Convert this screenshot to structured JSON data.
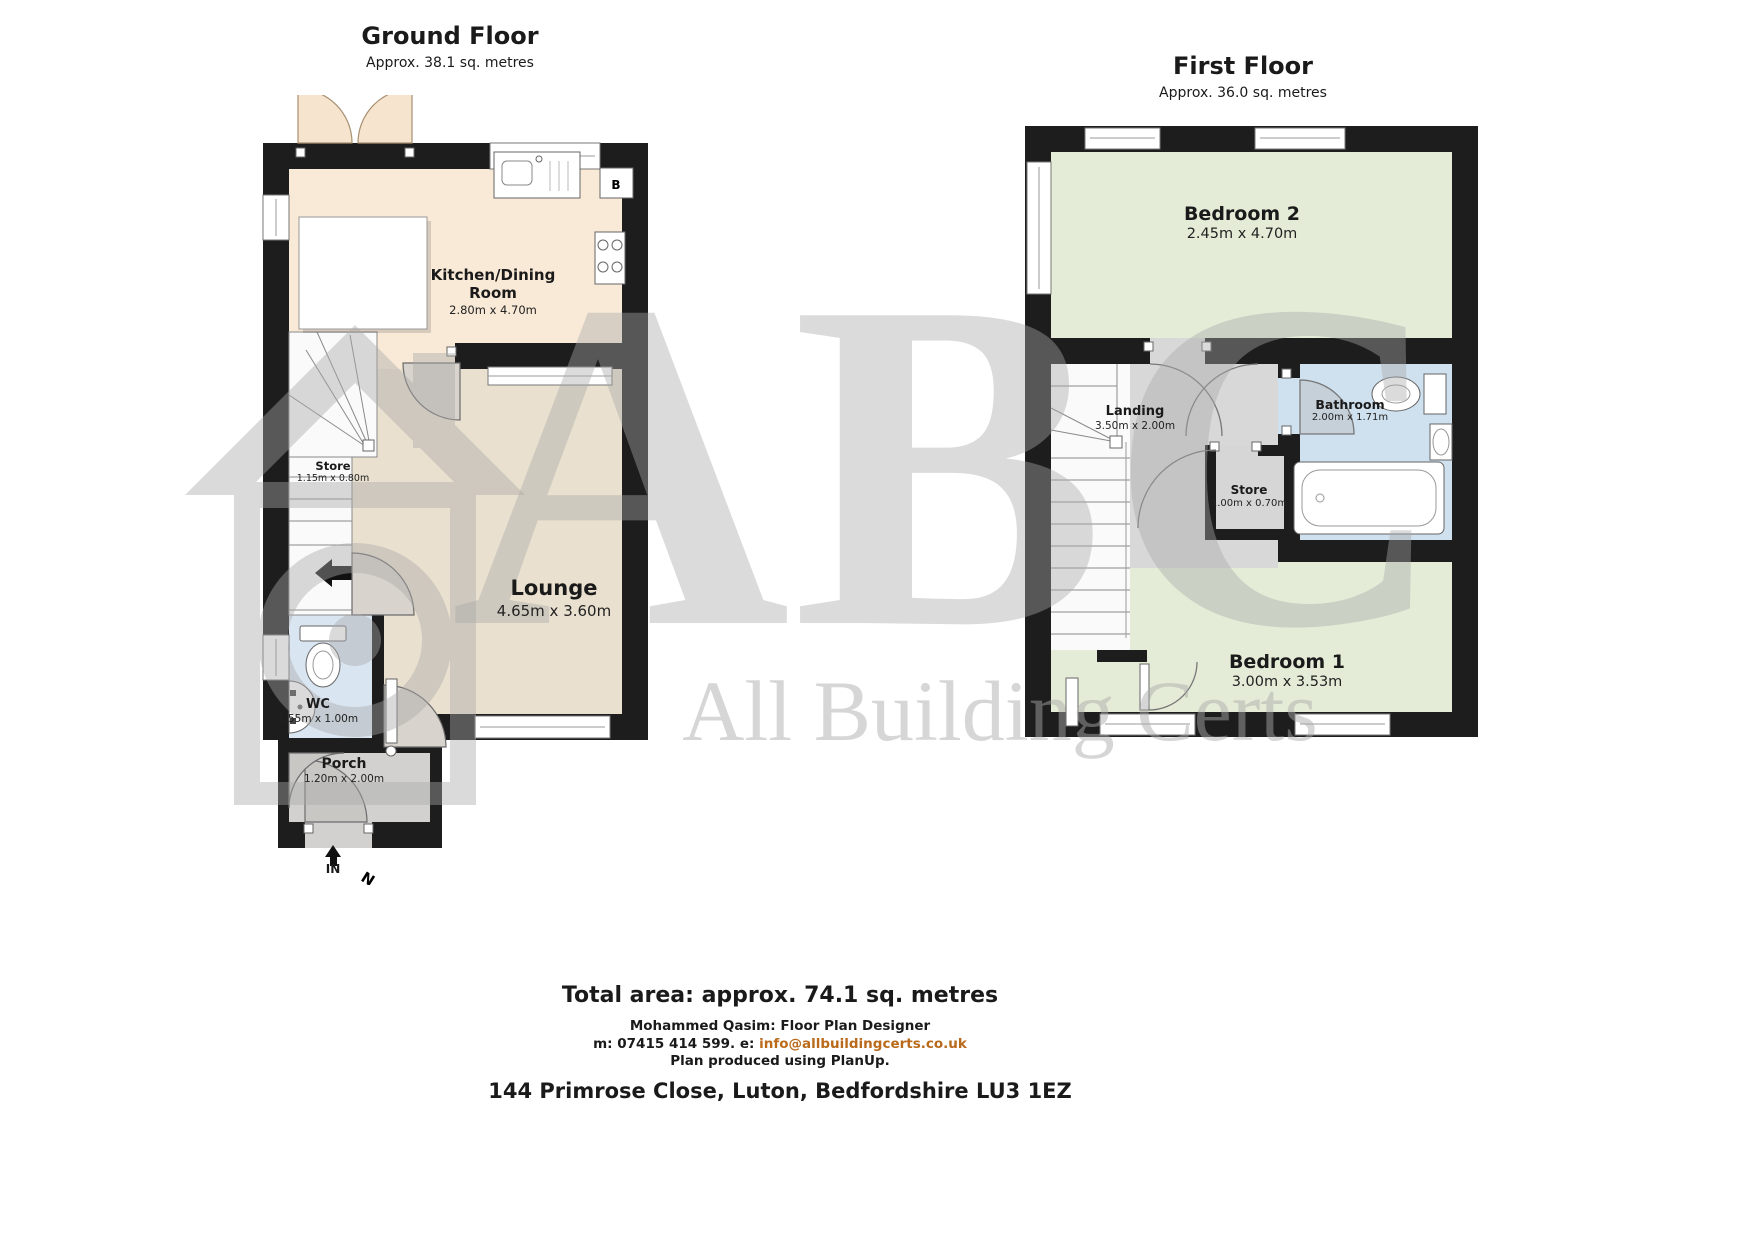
{
  "ground_floor": {
    "title": "Ground Floor",
    "subtitle": "Approx. 38.1 sq. metres",
    "rooms": {
      "kitchen": {
        "name": "Kitchen/Dining Room",
        "dims": "2.80m x 4.70m"
      },
      "store": {
        "name": "Store",
        "dims": "1.15m x 0.80m"
      },
      "lounge": {
        "name": "Lounge",
        "dims": "4.65m x 3.60m"
      },
      "wc": {
        "name": "WC",
        "dims": "1.55m x 1.00m"
      },
      "porch": {
        "name": "Porch",
        "dims": "1.20m x 2.00m"
      }
    },
    "boiler_label": "B",
    "entry_label": "IN",
    "compass_label": "N"
  },
  "first_floor": {
    "title": "First Floor",
    "subtitle": "Approx. 36.0 sq. metres",
    "rooms": {
      "bedroom2": {
        "name": "Bedroom 2",
        "dims": "2.45m x 4.70m"
      },
      "landing": {
        "name": "Landing",
        "dims": "3.50m x 2.00m"
      },
      "bathroom": {
        "name": "Bathroom",
        "dims": "2.00m x 1.71m"
      },
      "store": {
        "name": "Store",
        "dims": "1.00m x 0.70m"
      },
      "bedroom1": {
        "name": "Bedroom 1",
        "dims": "3.00m x 3.53m"
      }
    }
  },
  "watermark": {
    "letters": "ABC",
    "company": "All Building Certs"
  },
  "footer": {
    "total_area": "Total area: approx. 74.1 sq. metres",
    "designer": "Mohammed Qasim: Floor Plan Designer",
    "contact_prefix": "m: 07415 414 599.  e: ",
    "contact_email": "info@allbuildingcerts.co.uk",
    "produced": "Plan produced using PlanUp.",
    "address": "144 Primrose Close, Luton, Bedfordshire LU3 1EZ"
  },
  "colors": {
    "wall": "#1d1d1d",
    "kitchen": "#f9e9d7",
    "lounge": "#e9e0cf",
    "wc": "#d9e5f0",
    "porch": "#d2d1d0",
    "bedroom": "#e4ecd7",
    "landing": "#d8d8d8",
    "bathroom": "#cfe0ee",
    "email_accent": "#b96a1a"
  }
}
